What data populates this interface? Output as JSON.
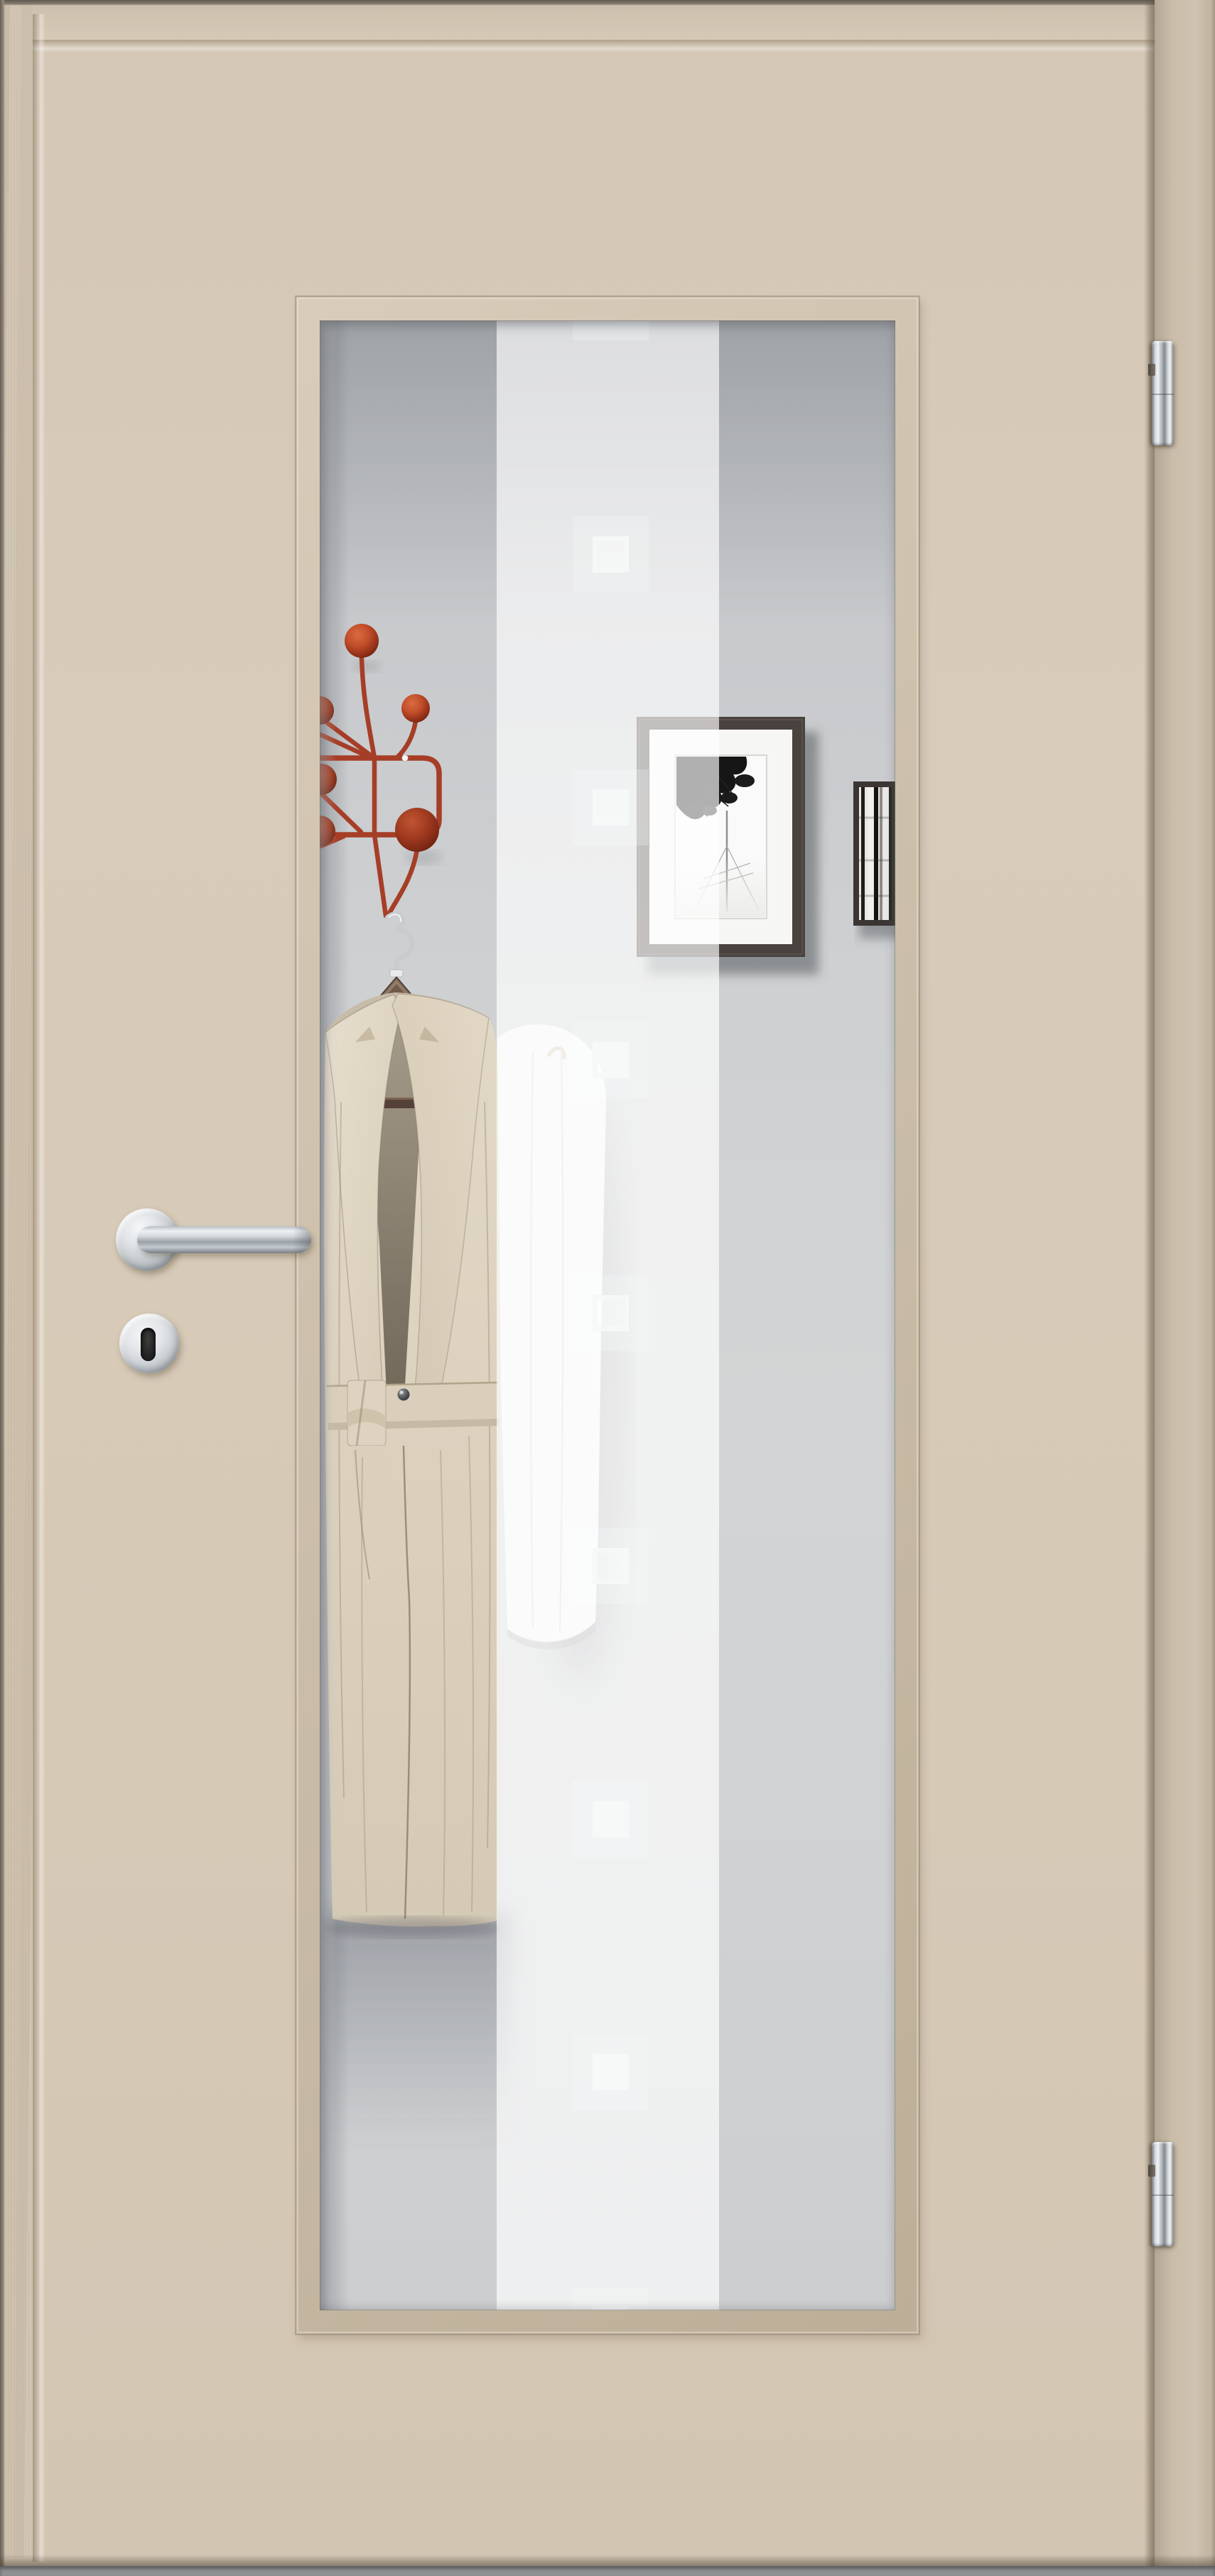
{
  "scene": {
    "subject": "interior wooden door with vertical glass light",
    "palette": {
      "door_face": "#d6c9b7",
      "door_jamb": "#c8bba8",
      "glazing_bead": "#ccbfaa",
      "floor": "#8e9092",
      "wall_behind_glass": "#cdcfd1",
      "frost_stripe": "rgba(255,255,255,0.66)",
      "motif_ring": "#f6f8f8",
      "coat_rack_red": "#a63e27",
      "rack_ball_red": "#b9472a",
      "hanger_wood": "#5d4839",
      "hanger_crossbar": "#554137",
      "trench_coat": "#dbd1bd",
      "white_garment": "#f4f4f2",
      "photo_frame_large": "#49423e",
      "photo_frame_small": "#3b3633",
      "photo_mat": "#f6f6f5",
      "hardware_chrome": "#c9ced2",
      "keyhole_black": "#1e1e1e"
    },
    "glass": {
      "motif_count": 9,
      "stripe_count": 1
    },
    "hardware": {
      "hinge_count": 2,
      "handle": "lever",
      "lock": "keyhole-escutcheon"
    },
    "behind_glass": {
      "coat_rack_knobs": 6,
      "framed_photos": 2,
      "garments": 2
    }
  }
}
